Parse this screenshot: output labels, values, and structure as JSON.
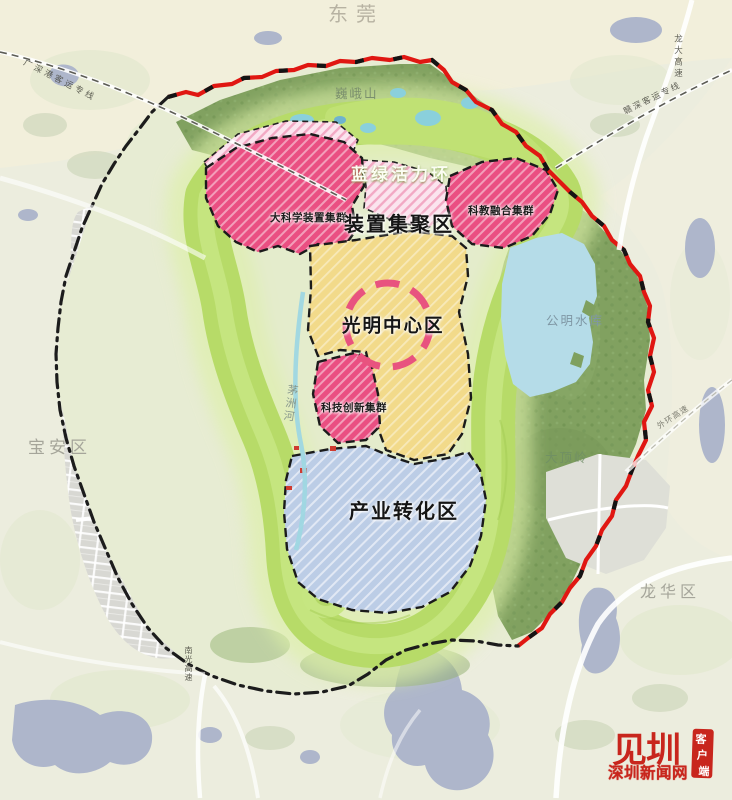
{
  "regions": {
    "dongguan": "东莞",
    "baoan": "宝安区",
    "longhua": "龙华区"
  },
  "zones": {
    "ring": "蓝绿活力环",
    "device_cluster": "装置集聚区",
    "big_science": "大科学装置集群",
    "sci_edu": "科教融合集群",
    "center": "光明中心区",
    "tech_innovation": "科技创新集群",
    "industry": "产业转化区"
  },
  "features": {
    "weie_mountain": "巍峨山",
    "gongming_reservoir": "公明水库",
    "dadingling": "大顶岭",
    "maozhou_river": "茅洲河"
  },
  "transport": {
    "gsg_rail": "广深港客运专线",
    "ganshen_rail": "赣深客运专线",
    "longda_expwy": "龙大高速",
    "outer_ring_expwy": "外环高速",
    "nanguang_expwy": "南光高速"
  },
  "logo": {
    "glyph": "见圳",
    "site": "深圳新闻网",
    "badge_chars": [
      "客",
      "户",
      "端"
    ]
  },
  "colors": {
    "cluster_pink": "#ea4f82",
    "center_yellow": "#f2da8a",
    "industry_blue": "#bccde6",
    "ring_green": "#b7db68",
    "forest_green": "#81a160",
    "boundary_red": "#e01712",
    "logo_red": "#c8261d"
  }
}
